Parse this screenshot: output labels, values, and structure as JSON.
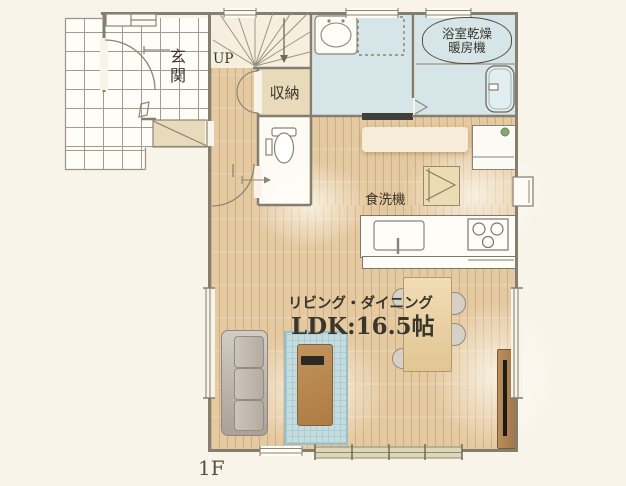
{
  "title": "1F floor plan",
  "floor_label": "1F",
  "rooms": {
    "entrance_label": "玄関",
    "stairs_up_label": "UP",
    "storage_label": "収納",
    "bath_heater_line1": "浴室乾燥",
    "bath_heater_line2": "暖房機",
    "dishwasher_label": "食洗機",
    "living_dining_label": "リビング・ダイニング",
    "ldk_size_label": "LDK:16.5帖"
  },
  "colors": {
    "background": "#f9f4ea",
    "wall": "#847e6f",
    "wood_floor": "#e5c9a0",
    "wet_room": "#d6e5e7",
    "tile": "#fefdf8",
    "storage_beige": "#e9dabc",
    "rug_blue": "#c6dde0",
    "low_table_wood": "#b9854e",
    "label_text": "#3b362c"
  }
}
